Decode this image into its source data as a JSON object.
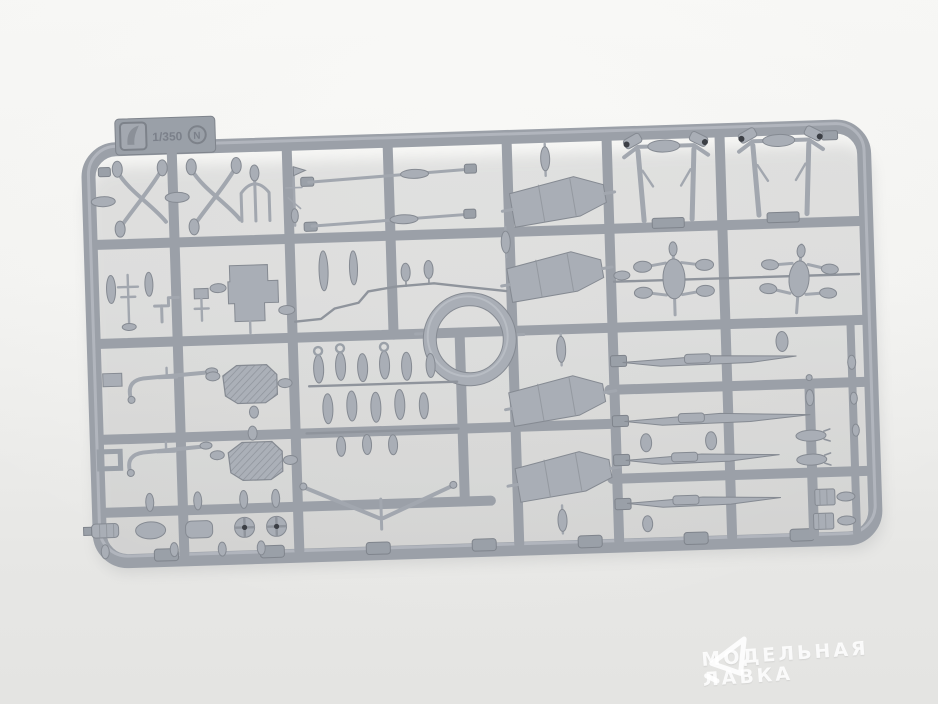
{
  "photo": {
    "background_top": "#f6f6f4",
    "background_bottom": "#e4e4e2"
  },
  "sprue": {
    "tab": {
      "scale_label": "1/350",
      "sprue_letter": "N"
    },
    "colors": {
      "plastic": "#9ba0a8",
      "plastic_highlight": "#c3c7cd",
      "plastic_shadow": "#7f848c",
      "part_fill": "#a9aeb6"
    }
  },
  "watermark": {
    "line1": "МОДЕЛЬНАЯ",
    "line2": "ЛАВКА",
    "color": "#ffffff"
  }
}
